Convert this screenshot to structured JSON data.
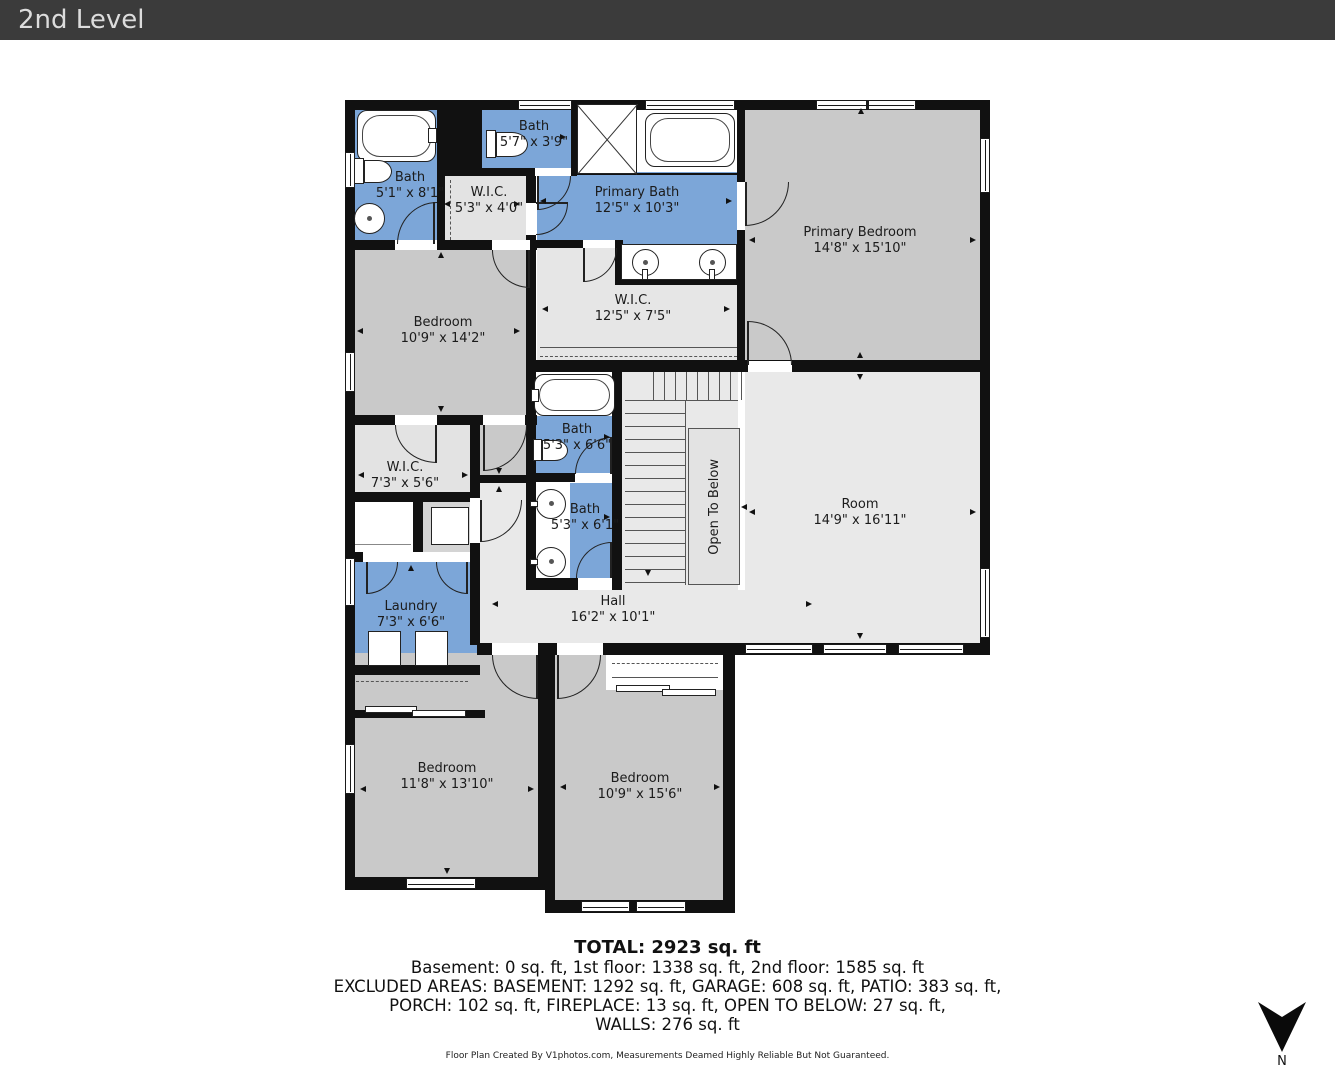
{
  "header": {
    "title": "2nd Level"
  },
  "rooms": [
    {
      "id": "bath-ensuite-left",
      "name": "Bath",
      "dims": "5'1\" x 8'1\""
    },
    {
      "id": "wic-small",
      "name": "W.I.C.",
      "dims": "5'3\" x 4'0\""
    },
    {
      "id": "bath-top",
      "name": "Bath",
      "dims": "5'7\" x 3'9\""
    },
    {
      "id": "primary-bath",
      "name": "Primary Bath",
      "dims": "12'5\" x 10'3\""
    },
    {
      "id": "primary-bedroom",
      "name": "Primary Bedroom",
      "dims": "14'8\" x 15'10\""
    },
    {
      "id": "bedroom-upper-left",
      "name": "Bedroom",
      "dims": "10'9\" x 14'2\""
    },
    {
      "id": "wic-primary",
      "name": "W.I.C.",
      "dims": "12'5\" x 7'5\""
    },
    {
      "id": "bath-middle-upper",
      "name": "Bath",
      "dims": "5'3\" x 6'6\""
    },
    {
      "id": "bath-middle-lower",
      "name": "Bath",
      "dims": "5'3\" x 6'1\""
    },
    {
      "id": "room",
      "name": "Room",
      "dims": "14'9\" x 16'11\""
    },
    {
      "id": "wic-left",
      "name": "W.I.C.",
      "dims": "7'3\" x 5'6\""
    },
    {
      "id": "laundry",
      "name": "Laundry",
      "dims": "7'3\" x 6'6\""
    },
    {
      "id": "hall",
      "name": "Hall",
      "dims": "16'2\" x 10'1\""
    },
    {
      "id": "bedroom-bottom-left",
      "name": "Bedroom",
      "dims": "11'8\" x 13'10\""
    },
    {
      "id": "bedroom-bottom-right",
      "name": "Bedroom",
      "dims": "10'9\" x 15'6\""
    }
  ],
  "open_to_below_label": "Open To Below",
  "compass": {
    "label": "N"
  },
  "summary": {
    "total": "TOTAL: 2923 sq. ft",
    "floors": "Basement: 0 sq. ft, 1st floor: 1338 sq. ft, 2nd floor: 1585 sq. ft",
    "excluded_1": "EXCLUDED AREAS: BASEMENT: 1292 sq. ft, GARAGE: 608 sq. ft, PATIO: 383 sq. ft,",
    "excluded_2": "PORCH: 102 sq. ft, FIREPLACE: 13 sq. ft, OPEN TO BELOW: 27 sq. ft,",
    "excluded_3": "WALLS: 276 sq. ft"
  },
  "disclaimer": "Floor Plan Created By V1photos.com, Measurements Deamed Highly Reliable But Not Guaranteed.",
  "colors": {
    "bath_fill": "#7CA6D8",
    "bedroom_fill": "#C9C9C9",
    "hall_fill": "#E9E9E9",
    "closet_fill": "#E3E3E3",
    "wall": "#111111",
    "header_bg": "#3B3B3B"
  }
}
